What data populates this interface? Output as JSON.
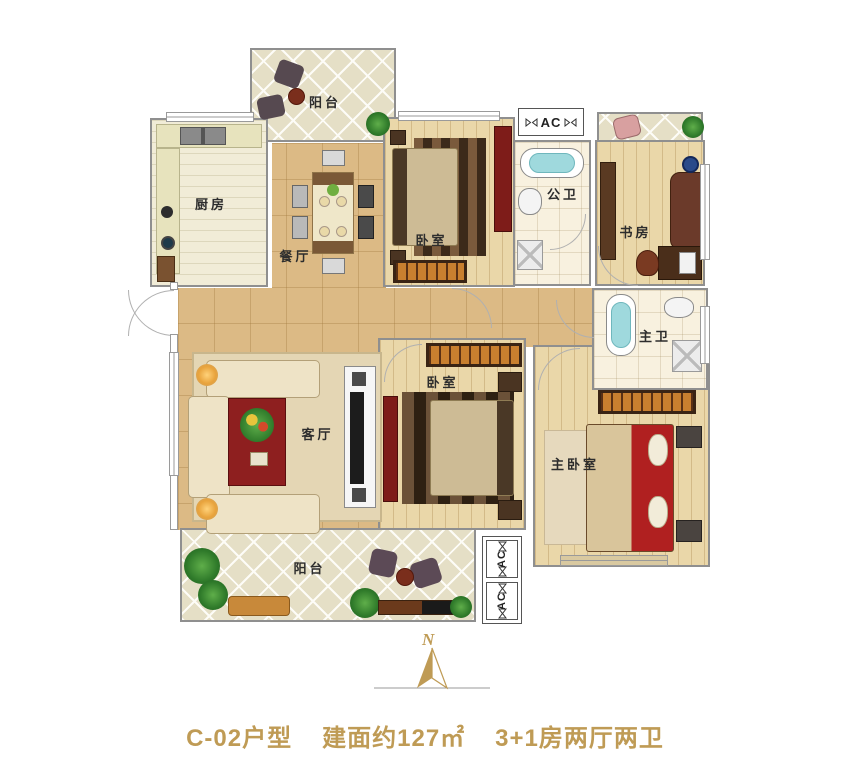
{
  "rooms": {
    "balcony_top": {
      "label": "阳台"
    },
    "kitchen": {
      "label": "厨房"
    },
    "dining": {
      "label": "餐厅"
    },
    "bedroom_top": {
      "label": "卧室"
    },
    "public_bath": {
      "label": "公卫"
    },
    "study": {
      "label": "书房"
    },
    "master_bath": {
      "label": "主卫"
    },
    "living": {
      "label": "客厅"
    },
    "bedroom_mid": {
      "label": "卧室"
    },
    "master_bedroom": {
      "label": "主卧室"
    },
    "balcony_bottom": {
      "label": "阳台"
    }
  },
  "ac_units": {
    "top": "AC",
    "bottom_1": "AC",
    "bottom_2": "AC"
  },
  "compass": {
    "letter": "N"
  },
  "caption": {
    "unit": "C-02户型",
    "area": "建面约127㎡",
    "layout": "3+1房两厅两卫"
  },
  "colors": {
    "accent_gold": "#bf9b55",
    "floor_tile": "#dcba85",
    "floor_wood": "#ead7a9",
    "cabinet_red": "#7e1c19"
  }
}
